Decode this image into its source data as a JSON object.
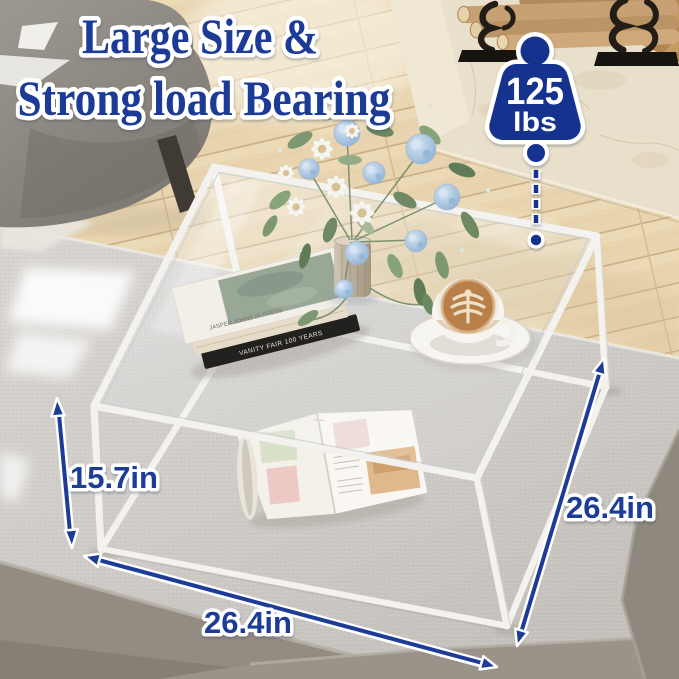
{
  "title": {
    "line1": "Large Size &",
    "line2": "Strong load Bearing"
  },
  "load_badge": {
    "icon": "kettlebell-weight-icon",
    "value": "125",
    "unit": "lbs"
  },
  "dimensions": {
    "height": "15.7in",
    "width": "26.4in",
    "depth": "26.4in"
  },
  "props": {
    "top_book_spine": "JASPER JOHNS IN PRESS",
    "black_book_spine": "VANITY FAIR 100 YEARS"
  },
  "colors": {
    "annotation_navy": "#1c3c97",
    "badge_navy": "#16338f",
    "outline_white": "#ffffff",
    "frame_white": "#f4f2ee",
    "wood_floor": "#e8d4ae",
    "stone_hearth": "#e9e0cb",
    "rug_gray": "#d6d3cf"
  }
}
